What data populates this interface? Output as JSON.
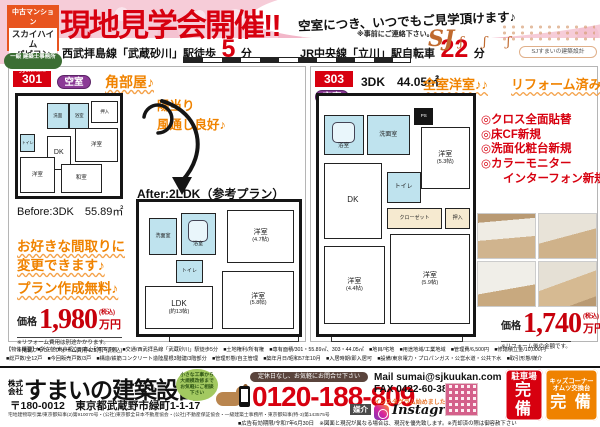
{
  "header": {
    "logo_tag": "中古マンション",
    "logo_name1": "スカイハイム",
    "logo_name2": "パピヨン",
    "logo_script": "Sumai no Jyukēhen",
    "logo_license": "一級 建築士事務所",
    "title": "現地見学会開催!!",
    "subtitle": "空室につき、いつでもご見学頂けます♪",
    "subtitle_note": "※事前にご連絡下さい。",
    "access1_pre": "西武拝島線「武蔵砂川」駅徒歩",
    "access1_num": "5",
    "access1_suf": "分",
    "access2_pre": "JR中央線「立川」駅自転車",
    "access2_num": "22",
    "access2_suf": "分",
    "mascot_big": "SJ",
    "mascot_small": "ʃ ʃ ʃ",
    "mascot_badge": "SJすまいの建築設計"
  },
  "unit301": {
    "number": "301",
    "vacancy": "空室",
    "corner": "角部屋♪",
    "sunny1": "陽当り",
    "sunny2": "風通し良好♪",
    "before_label": "Before:3DK　55.89㎡",
    "after_label": "After:2LDK（参考プラン）",
    "appeal1": "お好きな間取りに",
    "appeal2": "変更できます♪",
    "appeal3": "プラン作成無料♪",
    "price_label": "価格",
    "price": "1,980",
    "price_tax": "(税込)",
    "price_unit": "万円",
    "note1": "※リフォーム費用は別途かかります。",
    "note2": "※掲載プランリフォーム費用475万円(税込)",
    "before_rooms": {
      "wash": "洗面",
      "bath": "浴室",
      "oshiire": "押入",
      "toilet": "トイレ",
      "dk": "DK",
      "west1": "洋室",
      "west2": "洋室",
      "wa": "和室"
    },
    "after_rooms": {
      "wash": "洗面室",
      "bath": "浴室",
      "toilet": "トイレ",
      "west1": "洋室",
      "west1_size": "(4.7帖)",
      "ldk": "LDK",
      "ldk_size": "(約13帖)",
      "west2": "洋室",
      "west2_size": "(5.8帖)"
    }
  },
  "unit303": {
    "number": "303",
    "layout": "3DK　44.05㎡",
    "vacancy": "空室",
    "appeal1": "全室洋室♪♪",
    "appeal2": "リフォーム済み♪",
    "features": [
      "◎クロス全面貼替",
      "◎床CF新規",
      "◎洗面化粧台新規",
      "◎カラーモニター",
      "インターフォン新規"
    ],
    "price_label": "価格",
    "price": "1,740",
    "price_tax": "(税込)",
    "price_unit": "万円",
    "note": "※リフォーム後の金額です。",
    "rooms": {
      "bath": "浴室",
      "wash": "洗面室",
      "ps": "PS",
      "west1": "洋室",
      "west1_size": "(5.3帖)",
      "dk": "DK",
      "toilet": "トイレ",
      "closet": "クローゼット",
      "oshiire": "押入",
      "west3": "洋室",
      "west3_size": "(4.4帖)",
      "west2": "洋室",
      "west2_size": "(5.9帖)"
    }
  },
  "overview": {
    "line1": "【物件概要】■所在地/東京都立川市上砂町5丁目　■交通/西武拝島線「武蔵砂川」駅徒歩5分　■土地権利/所有権　■専有面積/301・55.89㎡、303・44.05㎡　■地目/宅地　■用途地域/工業地域　■管理費/6,500円　■修繕積立金/10,000円",
    "line2": "■総戸数/全12戸　■今回販売戸数/3戸　■構造/鉄筋コンクリート造陸屋根3階建/3階部分　■管理形態/自主管理　■築年月日/昭和57年10月　■入居時期/即入居可　■設備/東京電力・プロパンガス・公営水道・公共下水　■取引形態/媒介"
  },
  "footer": {
    "company_prefix": "株式 会社",
    "company": "すまいの建築設計",
    "address": "〒180-0012　東京都武蔵野市緑町1-1-17",
    "license": "宅地建物取引業/東京都知事(2)第910070号・(公社)東京都全日本不動産協会・(公社)不動産保証協会・一級建築士事務所・東京都知事(特-3)第143575号",
    "bubble": "小さな工事から大規模改修までお気軽にご相談下さい",
    "hours": "定休日なし、お気軽にお問合せ下さい",
    "phone": "0120-188-809",
    "deal_type": "媒介",
    "mail": "Mail sumai@sjkuukan.com",
    "fax": "FAX 0422-60-3833",
    "insta_note": "インスタグラム始めました。",
    "insta": "Instagram",
    "parking1": "駐車場",
    "parking2": "完 備",
    "kids1": "キッズコーナー",
    "kids2": "オムツ交換台",
    "kids3": "完 備",
    "expiry": "■広告有効期限/令和7年6月30日　※図面と現況が異なる場合は、現況を優先致します。※売却済の際は御容赦下さい"
  }
}
